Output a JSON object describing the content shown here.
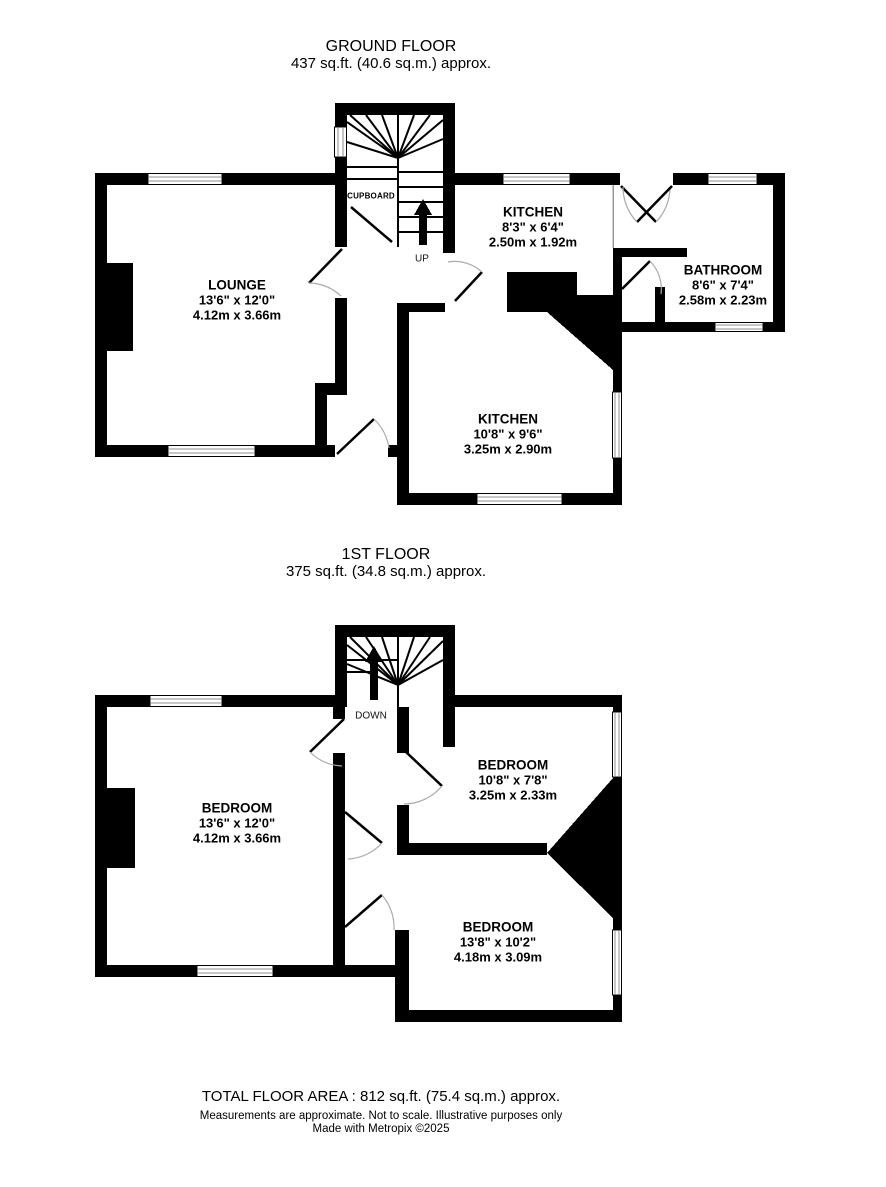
{
  "ground_floor": {
    "title": "GROUND FLOOR",
    "subtitle": "437 sq.ft. (40.6 sq.m.) approx.",
    "rooms": {
      "lounge": {
        "name": "LOUNGE",
        "imperial": "13'6\"  x 12'0\"",
        "metric": "4.12m  x 3.66m"
      },
      "kitchen_top": {
        "name": "KITCHEN",
        "imperial": "8'3\"  x 6'4\"",
        "metric": "2.50m  x 1.92m"
      },
      "bathroom": {
        "name": "BATHROOM",
        "imperial": "8'6\"  x 7'4\"",
        "metric": "2.58m  x 2.23m"
      },
      "kitchen_main": {
        "name": "KITCHEN",
        "imperial": "10'8\"  x 9'6\"",
        "metric": "3.25m  x 2.90m"
      }
    },
    "labels": {
      "cupboard": "CUPBOARD",
      "up": "UP"
    }
  },
  "first_floor": {
    "title": "1ST FLOOR",
    "subtitle": "375 sq.ft. (34.8 sq.m.) approx.",
    "rooms": {
      "bedroom_left": {
        "name": "BEDROOM",
        "imperial": "13'6\"  x 12'0\"",
        "metric": "4.12m  x 3.66m"
      },
      "bedroom_right": {
        "name": "BEDROOM",
        "imperial": "10'8\"  x 7'8\"",
        "metric": "3.25m  x 2.33m"
      },
      "bedroom_bottom": {
        "name": "BEDROOM",
        "imperial": "13'8\"  x 10'2\"",
        "metric": "4.18m  x 3.09m"
      }
    },
    "labels": {
      "down": "DOWN"
    }
  },
  "footer": {
    "total": "TOTAL FLOOR AREA : 812 sq.ft. (75.4 sq.m.) approx.",
    "disclaimer": "Measurements are approximate.  Not to scale.  Illustrative purposes only",
    "credit": "Made with Metropix ©2025"
  },
  "colors": {
    "wall": "#000000",
    "door_arc": "#aaaaaa",
    "window_line": "#8f8f8f"
  }
}
